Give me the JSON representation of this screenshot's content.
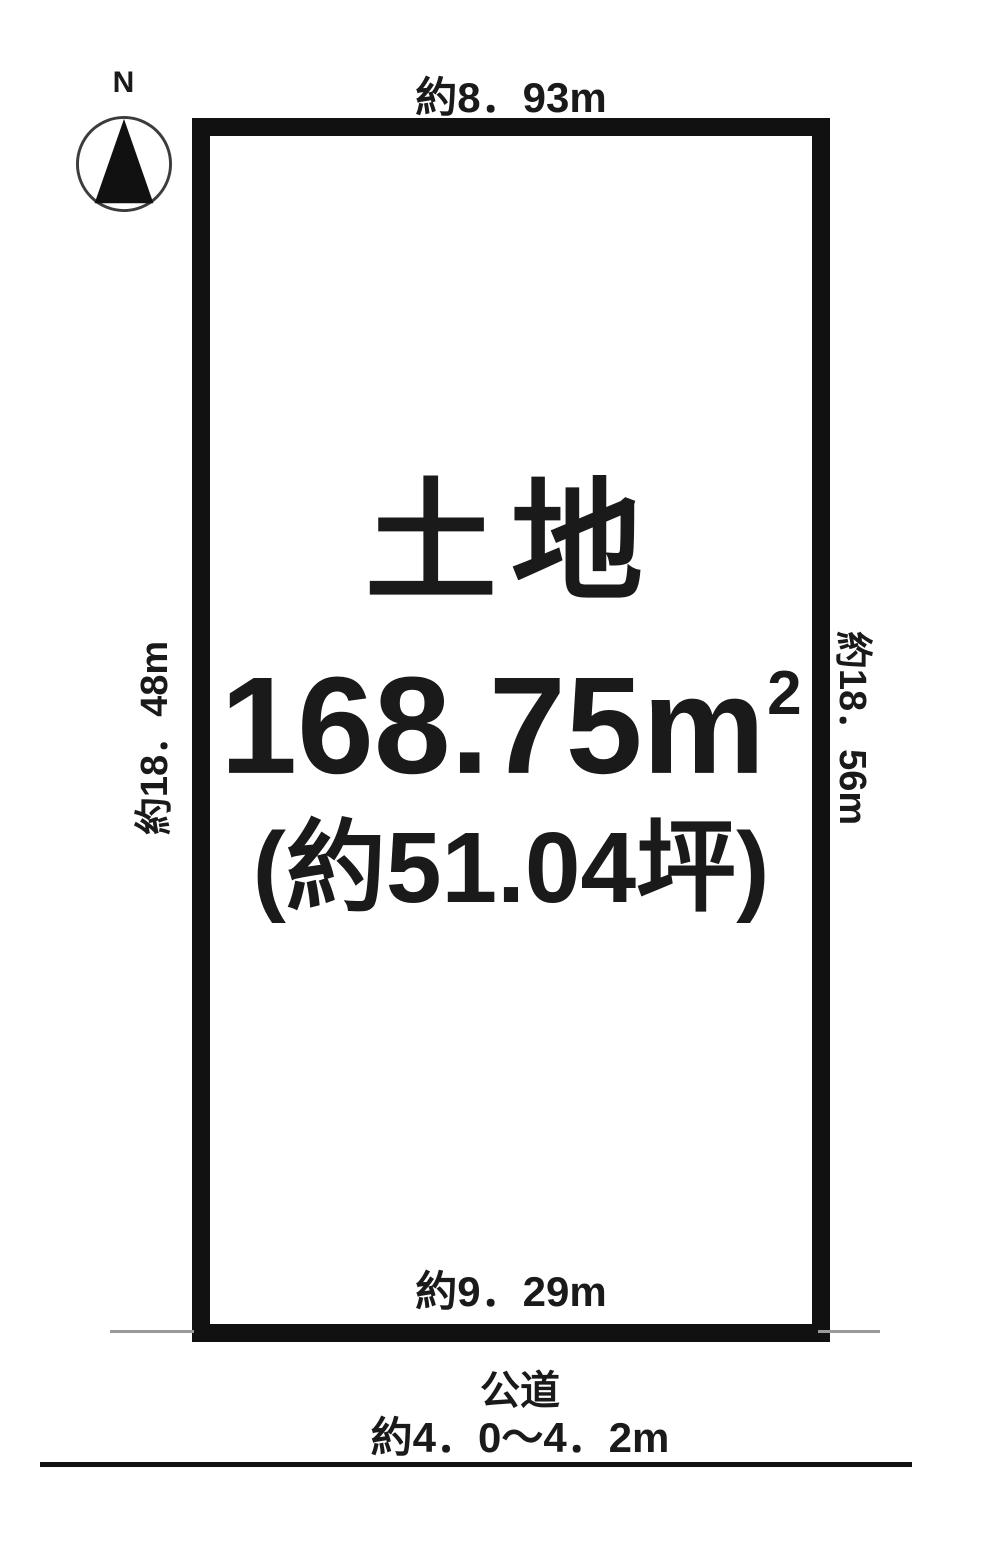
{
  "colors": {
    "border": "#111111",
    "text": "#1a1a1a",
    "extension_line": "#9a9a9a"
  },
  "compass": {
    "north_label": "N"
  },
  "plot": {
    "title": "土地",
    "area_value": "168.75m",
    "area_exponent": "2",
    "area_tsubo": "(約51.04坪)",
    "dimensions": {
      "top": "約8．93m",
      "bottom": "約9．29m",
      "left": "約18．48m",
      "right": "約18．56m"
    }
  },
  "road": {
    "name": "公道",
    "width": "約4．0〜4．2m"
  }
}
